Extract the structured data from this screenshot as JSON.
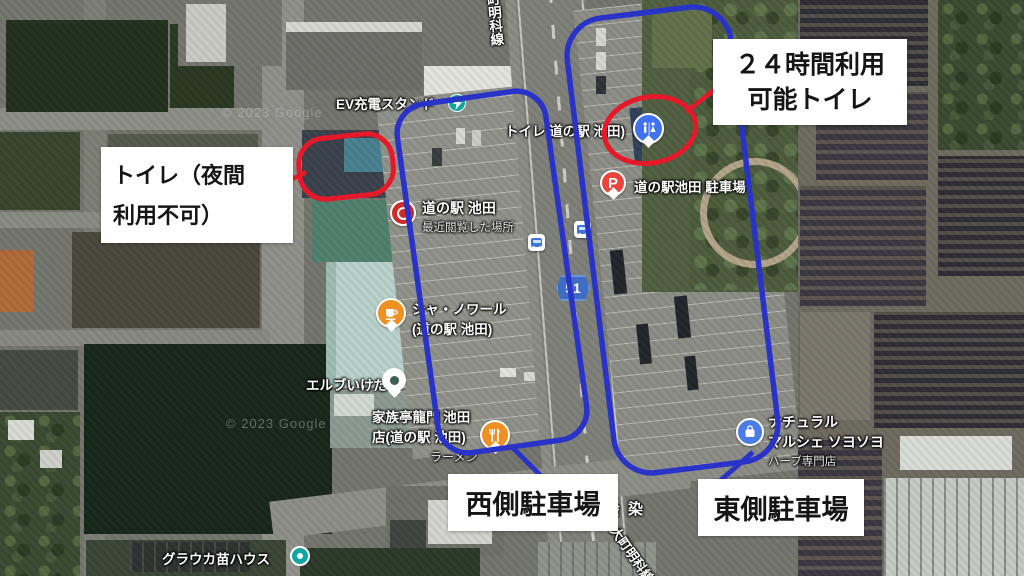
{
  "map": {
    "attribution": "© 2023 Google",
    "route_shield": "51",
    "road_label_top": "町明科線",
    "road_label_bottom": "大町明科線",
    "district_label": "会染",
    "pois": {
      "ev_station": {
        "label": "EV充電スタンド",
        "icon": "ev-charger-icon",
        "icon_color": "#0ba6a2"
      },
      "toilet": {
        "label": "トイレ 道の駅 池田)",
        "icon": "restroom-icon",
        "icon_color": "#4073f0"
      },
      "michinoeki": {
        "label": "道の駅 池田",
        "sublabel": "最近閲覧した場所",
        "icon": "recently-viewed-icon",
        "icon_color": "#cc2b27"
      },
      "parking": {
        "label": "道の駅池田 駐車場",
        "icon": "parking-icon",
        "icon_color": "#e8453c"
      },
      "cafe": {
        "label": "シャ・ノワール",
        "label2": "(道の駅 池田)",
        "icon": "coffee-icon",
        "icon_color": "#f09022"
      },
      "herb_shop": {
        "label": "エルブいけだ",
        "icon": "place-pin-icon",
        "icon_color": "#3c5f51"
      },
      "restaurant": {
        "label": "家族亭龍門 池田",
        "label2": "店(道の駅 池田)",
        "sublabel": "ラーメン",
        "icon": "restaurant-icon",
        "icon_color": "#f09022"
      },
      "marche": {
        "label": "ナチュラル",
        "label2": "マルシェ ソヨソヨ",
        "sublabel": "ハーブ専門店",
        "icon": "shopping-icon",
        "icon_color": "#4b7be5"
      },
      "nursery": {
        "label": "グラウカ苗ハウス",
        "icon": "place-dot-icon",
        "icon_color": "#0fa7a1"
      },
      "bus_stops": {
        "icon": "bus-stop-icon",
        "icon_color": "#3f74e0"
      }
    }
  },
  "annotations": {
    "toilet_24h": {
      "line1": "２４時間利用",
      "line2": "可能トイレ"
    },
    "toilet_night": {
      "line1": "トイレ（夜間",
      "line2": "利用不可）"
    },
    "west_parking": {
      "label": "西側駐車場"
    },
    "east_parking": {
      "label": "東側駐車場"
    },
    "colors": {
      "highlight_red": "#e6192b",
      "outline_blue": "#2a33c8",
      "callout_bg": "#ffffff",
      "callout_text": "#151515"
    }
  }
}
